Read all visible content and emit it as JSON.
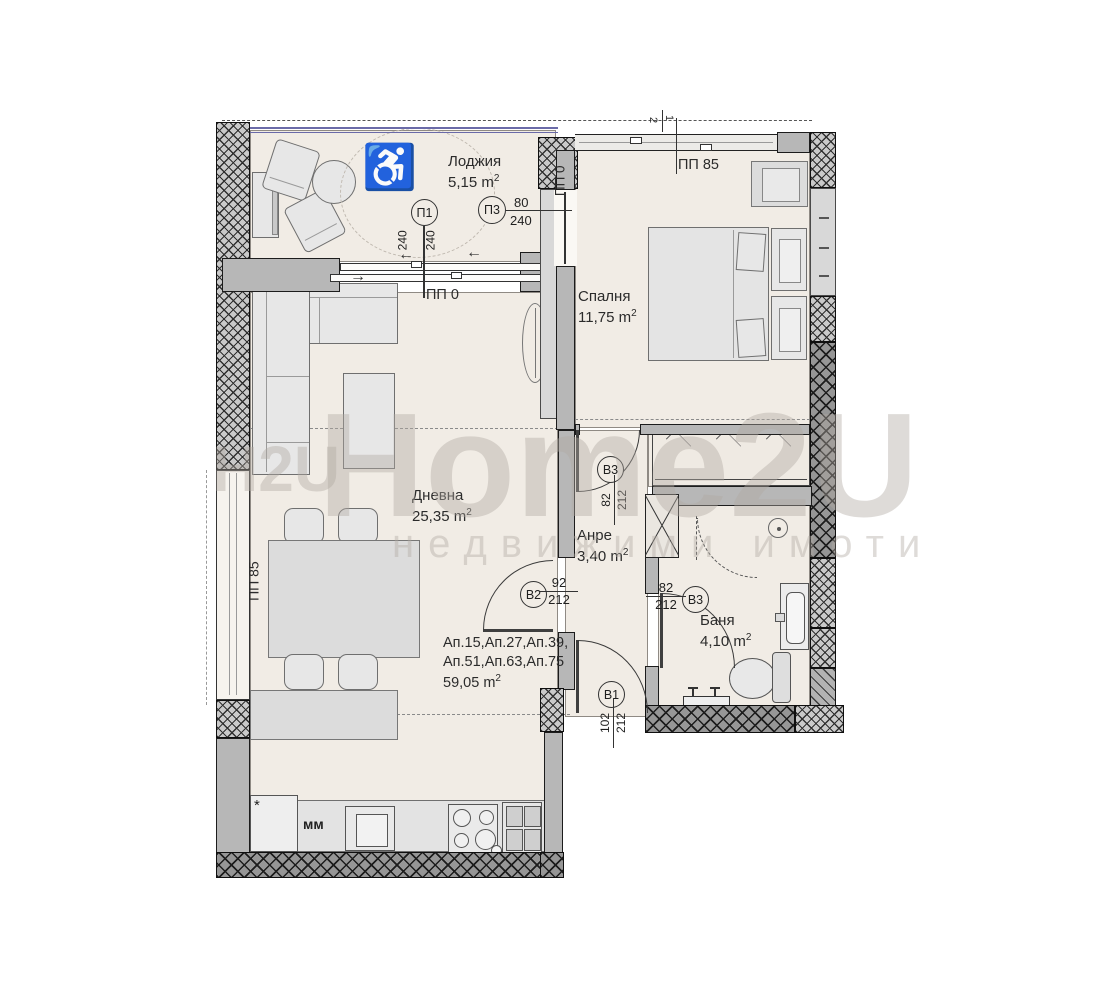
{
  "watermark": {
    "brand": "Home2U",
    "tagline": "недвижими имоти",
    "logo": "H2U"
  },
  "rooms": {
    "loggia": {
      "name": "Лоджия",
      "area": "5,15 m",
      "sup": "2"
    },
    "bedroom": {
      "name": "Спалня",
      "area": "11,75 m",
      "sup": "2"
    },
    "living": {
      "name": "Дневна",
      "area": "25,35 m",
      "sup": "2"
    },
    "hall": {
      "name": "Анре",
      "area": "3,40 m",
      "sup": "2"
    },
    "bath": {
      "name": "Баня",
      "area": "4,10 m",
      "sup": "2"
    }
  },
  "apartment": {
    "line1": "Ап.15,Ап.27,Ап.39,",
    "line2": "Ап.51,Ап.63,Ап.75",
    "area": "59,05 m",
    "sup": "2"
  },
  "markers": {
    "p1": {
      "id": "П1",
      "dim_a": "240",
      "dim_b": "240"
    },
    "p3": {
      "id": "П3",
      "width": "80",
      "height": "240"
    },
    "b3_bedroom": {
      "id": "В3",
      "width": "82",
      "height": "212"
    },
    "b2": {
      "id": "В2",
      "width": "92",
      "height": "212"
    },
    "b3_bath": {
      "id": "В3",
      "width": "82",
      "height": "212"
    },
    "b1": {
      "id": "В1",
      "width": "102",
      "height": "212"
    }
  },
  "wall_labels": {
    "pp0_door": "ПП 0",
    "pp0_wall": "ПП 0",
    "pp85_window": "ПП 85",
    "pp85_left": "ПП 85"
  },
  "kitchen": {
    "mm": "мм",
    "fridge_mark": "*"
  },
  "top_marks": {
    "a": "2",
    "b": "1"
  },
  "icons": {
    "wheelchair": "♿",
    "arrow_left": "←",
    "arrow_right": "→"
  },
  "colors": {
    "floor": "#f1ece5",
    "wall": "#c9c9c9",
    "wall_dark": "#969696",
    "rail_accent": "#6a6aa8",
    "watermark": "#b0a9a1",
    "line": "#333333"
  }
}
